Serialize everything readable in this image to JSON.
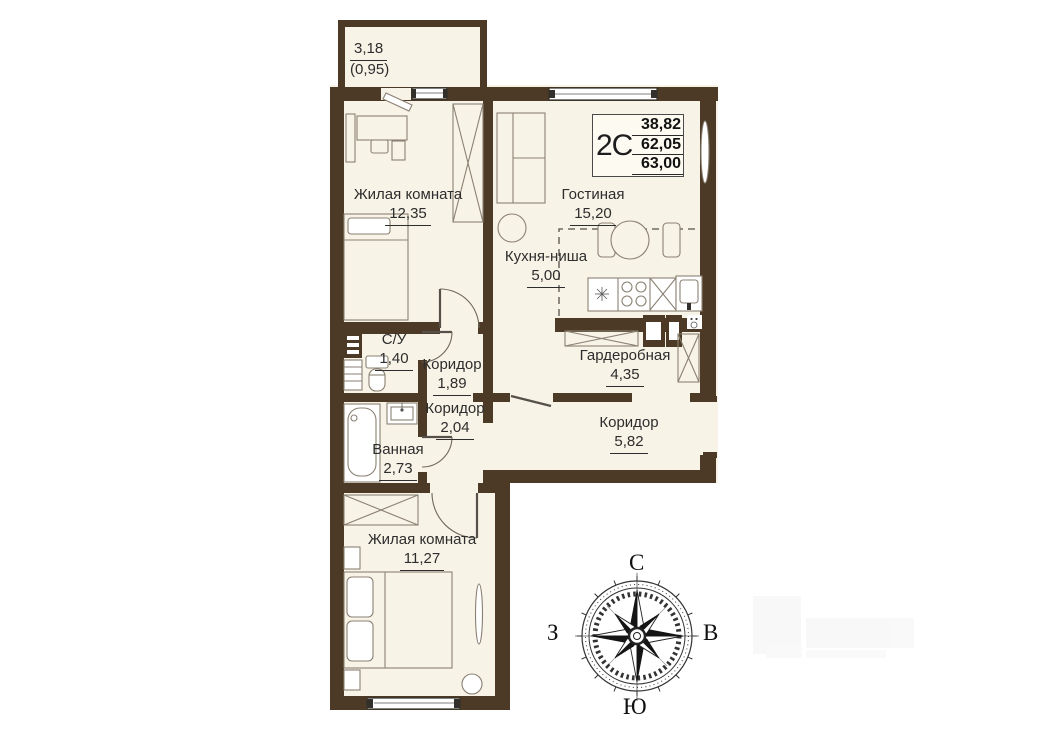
{
  "info_box": {
    "type": "2С",
    "values": [
      "38,82",
      "62,05",
      "63,00"
    ]
  },
  "balcony": {
    "area": "3,18",
    "coeff": "(0,95)"
  },
  "rooms": [
    {
      "name": "Жилая комната",
      "area": "12,35"
    },
    {
      "name": "Гостиная",
      "area": "15,20"
    },
    {
      "name": "Кухня-ниша",
      "area": "5,00"
    },
    {
      "name": "С/У",
      "area": "1,40"
    },
    {
      "name": "Коридор",
      "area": "1,89"
    },
    {
      "name": "Коридор",
      "area": "2,04"
    },
    {
      "name": "Ванная",
      "area": "2,73"
    },
    {
      "name": "Гардеробная",
      "area": "4,35"
    },
    {
      "name": "Коридор",
      "area": "5,82"
    },
    {
      "name": "Жилая комната",
      "area": "11,27"
    }
  ],
  "compass": {
    "north": "С",
    "south": "Ю",
    "west": "З",
    "east": "В"
  },
  "colors": {
    "wall": "#4d3a26",
    "floor": "#f8f3e7",
    "furniture_line": "#8a8173",
    "text": "#2d2d2d"
  }
}
